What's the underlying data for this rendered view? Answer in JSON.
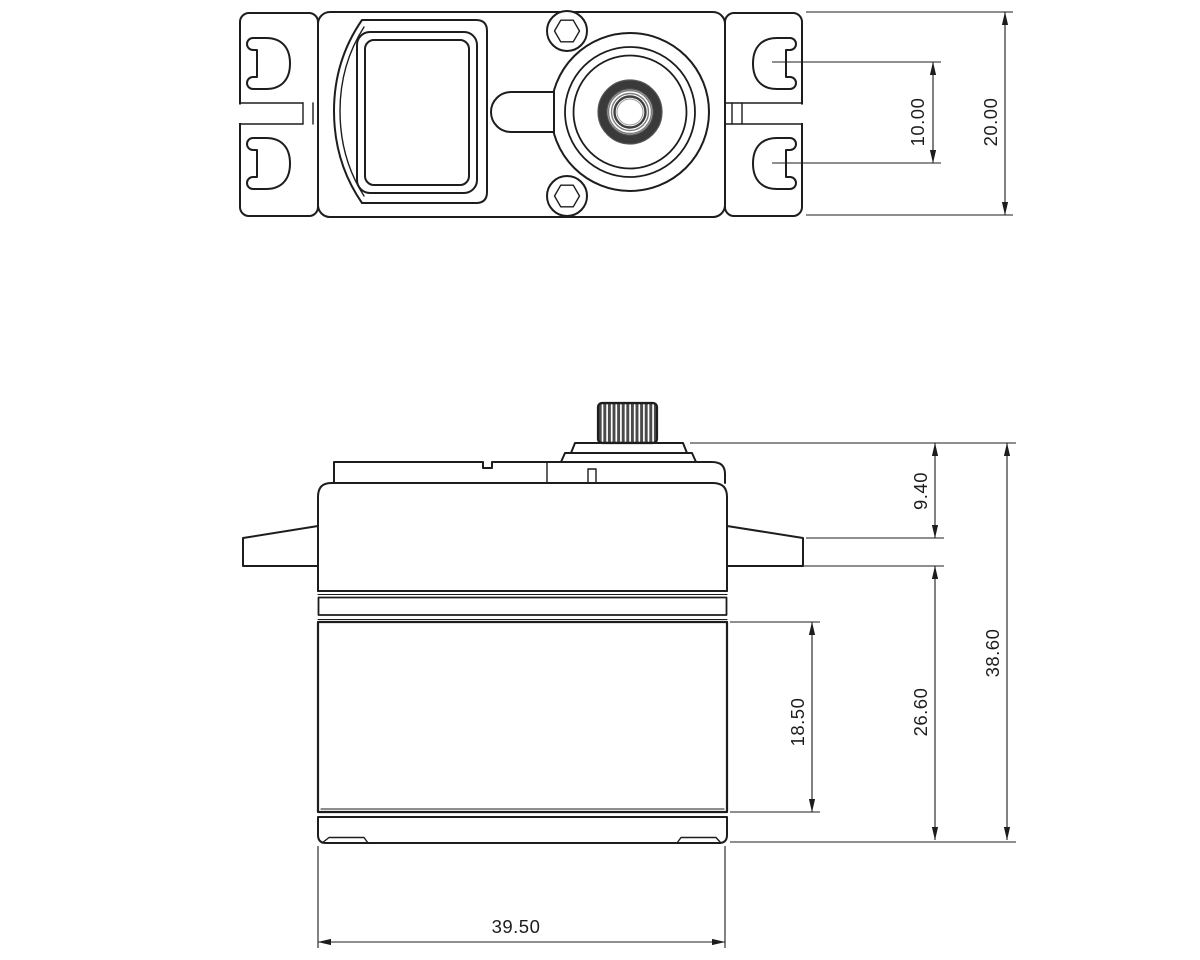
{
  "drawing": {
    "ink_color": "#1d1d1d",
    "background_color": "#ffffff",
    "dims": {
      "slot_pitch": "10.00",
      "tab_span": "20.00",
      "top_to_flange": "9.40",
      "overall_height": "38.60",
      "flange_to_bottom": "26.60",
      "lower_body_height": "18.50",
      "body_width": "39.50"
    }
  }
}
